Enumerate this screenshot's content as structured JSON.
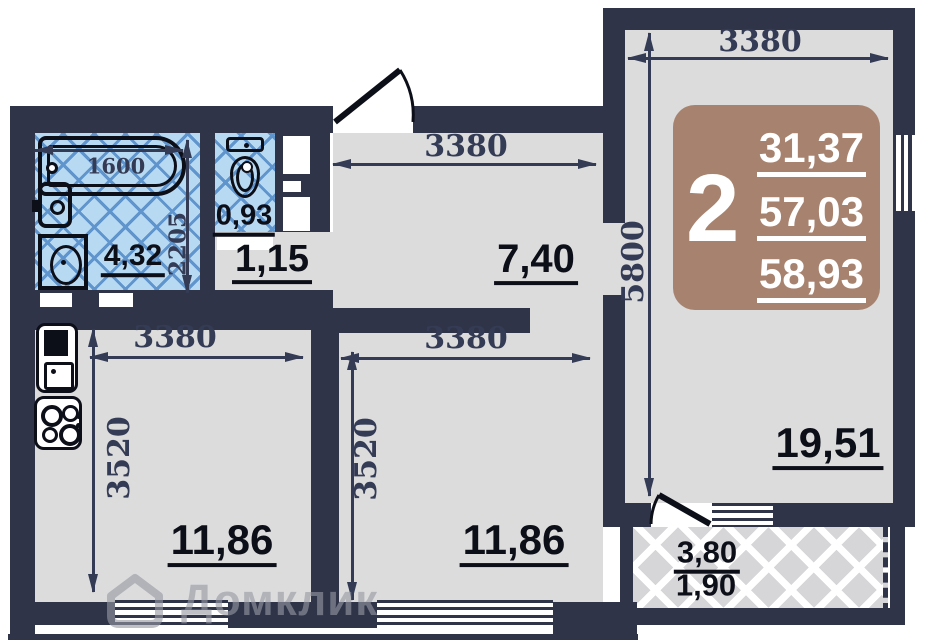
{
  "badge": {
    "rooms": "2",
    "living_area": "31,37",
    "area_without_balcony": "57,03",
    "total_area": "58,93"
  },
  "areas": {
    "bathroom": "4,32",
    "wc": "0,93",
    "hall": "1,15",
    "corridor": "7,40",
    "kitchen": "11,86",
    "bedroom": "11,86",
    "living_room": "19,51",
    "balcony_full": "3,80",
    "balcony_reduced": "1,90"
  },
  "dimensions": {
    "bathtub_length": "1600",
    "bathroom_depth": "2205",
    "corridor_width": "3380",
    "kitchen_width": "3380",
    "kitchen_depth": "3520",
    "bedroom_width": "3380",
    "bedroom_depth": "3520",
    "living_room_width": "3380",
    "living_room_length": "5800"
  },
  "watermark": {
    "label": "Домклик"
  },
  "colors": {
    "wall": "#2f3448",
    "floor": "#dcdcdd",
    "tile": "#b8d9f2",
    "tile_line": "#5f94cd",
    "badge": "#a7826e",
    "dim_text": "#343b55"
  }
}
